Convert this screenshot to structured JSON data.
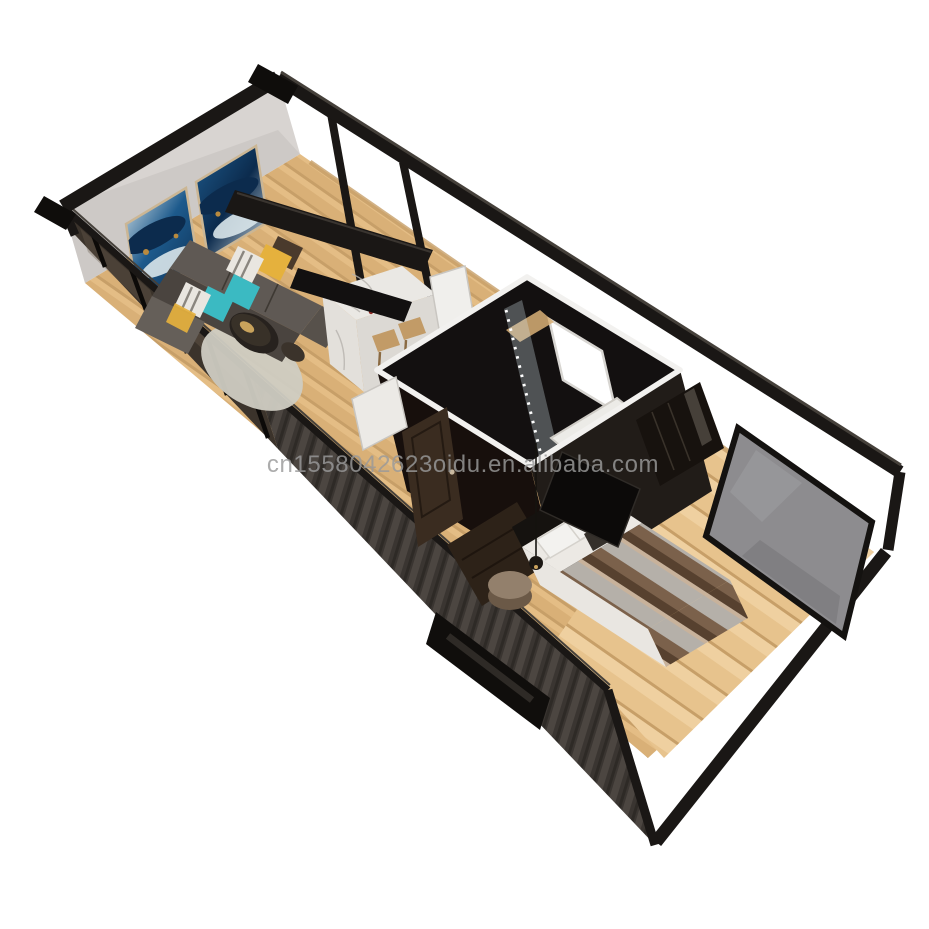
{
  "meta": {
    "title": "Container tiny home 3D cutaway render",
    "view": "isometric top-down cutaway",
    "background": "white studio"
  },
  "watermark": {
    "text": "cn1558042623oidu.en.alibaba.com"
  },
  "colors": {
    "bg": "#ffffff",
    "watermark": "#9a9a9a",
    "frame": "#1a1715",
    "frameLight": "#45403a",
    "innerBand": "#14110e",
    "glassWall": "#3b332b",
    "endWallWhite": "#d8d4d1",
    "wood": "#d9b077",
    "woodDark": "#c79f68",
    "woodLight": "#e4bd85",
    "woodBright": "#e7c38d",
    "corr1": "#3a3531",
    "corr2": "#4c4641",
    "corr3": "#2e2a26",
    "rug": "#cfccc2",
    "sofa": "#5f5954",
    "sofaDark": "#4a443f",
    "pillowYellow": "#e5b13d",
    "pillowTeal": "#3bbac2",
    "pillowWhite": "#e9e6e0",
    "pillowBrown": "#4a3a2c",
    "tableDark": "#27221e",
    "marble": "#eae8e4",
    "marbleSide": "#dcd9d4",
    "stool": "#c29b67",
    "hoodBlack": "#121010",
    "bathWall": "#131010",
    "bathWallLit": "#211c18",
    "bathWallDark": "#170f0c",
    "trimWhite": "#f2f1ef",
    "trayWhite": "#ecebe7",
    "showerGlass": "#cfe0e6",
    "doorBrown": "#3a2c20",
    "dresserBrown": "#2d2218",
    "sheetWhite": "#e9e6e1",
    "blanketA": "#b5b0a9",
    "blanketB": "#7b614b",
    "blanketC": "#57412f",
    "blanketD": "#c8b29b",
    "headboard": "#15120f",
    "nightstandTop": "#93806c",
    "nightstandBody": "#6b5947",
    "grayGlass": "#8d8c8f",
    "fridgeWhite": "#f0efec",
    "artBlue": "#1d5a8c",
    "artDeep": "#0c2b4d",
    "artLight": "#d9e5ea",
    "artGold": "#b98a3e",
    "frameTan": "#cbb694"
  }
}
